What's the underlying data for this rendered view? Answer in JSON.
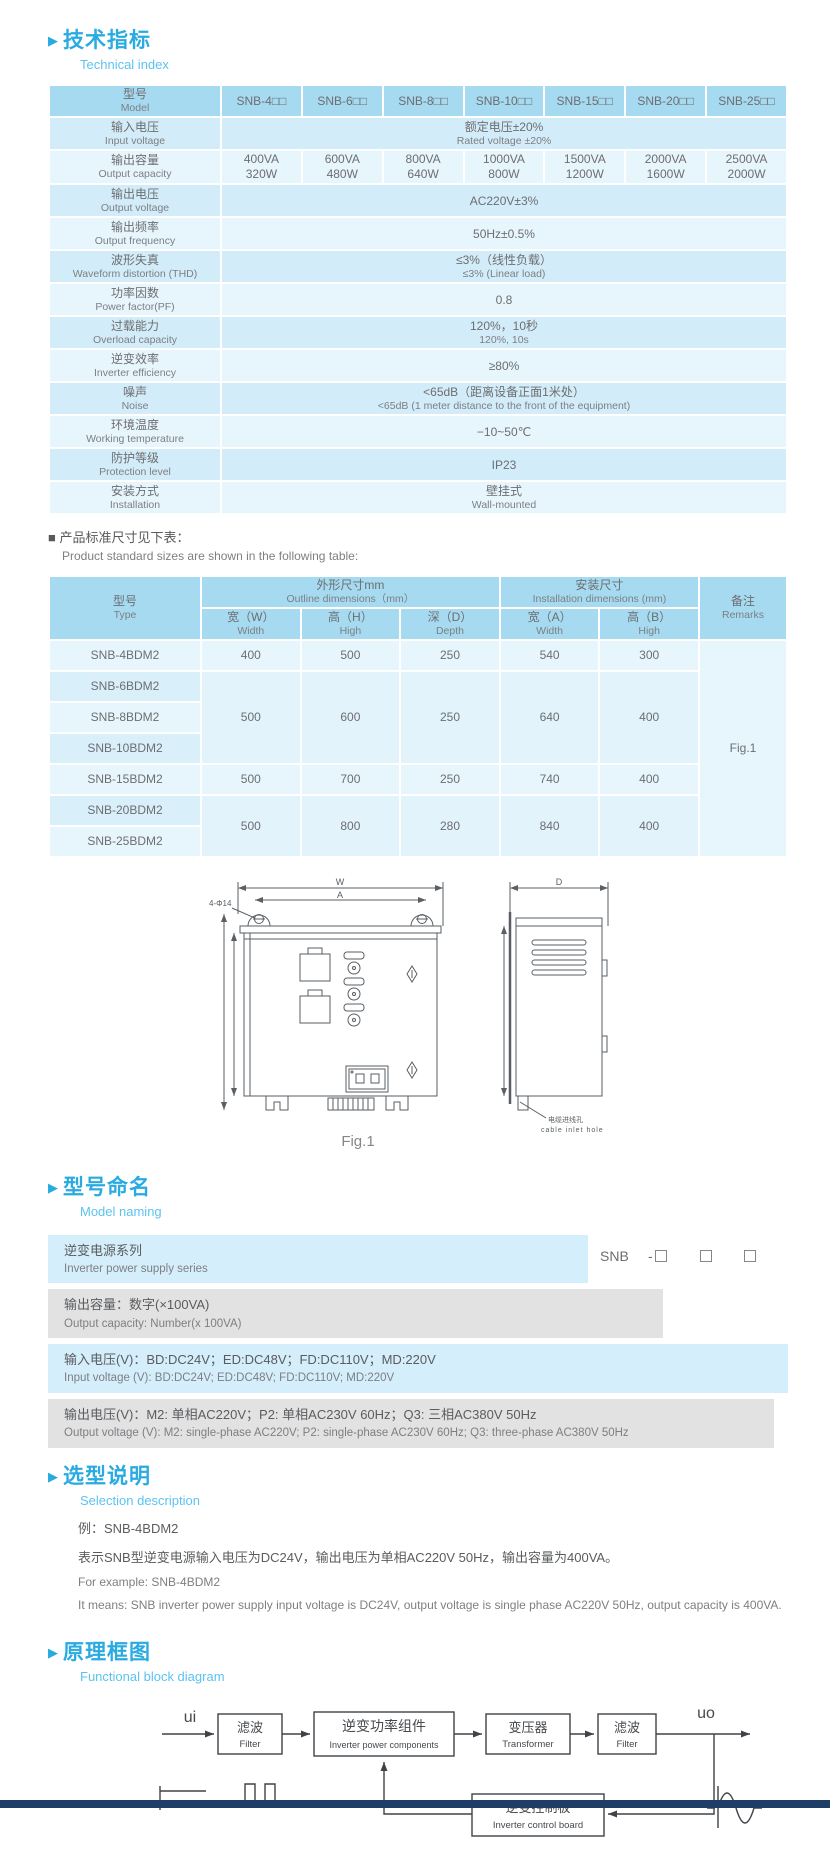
{
  "colors": {
    "accent": "#29abe2",
    "accent_light": "#5cc3f0",
    "table_header_bg": "#a6daf1",
    "row_dark": "#d3ecf9",
    "row_light": "#e7f5fd",
    "blue_band": "#d5eefb",
    "gray_band": "#e2e2e3",
    "footer_bar": "#1e3e68",
    "text_gray": "#6d6e71"
  },
  "sections": {
    "technical": {
      "zh": "技术指标",
      "en": "Technical index"
    },
    "naming": {
      "zh": "型号命名",
      "en": "Model naming"
    },
    "selection": {
      "zh": "选型说明",
      "en": "Selection description"
    },
    "block": {
      "zh": "原理框图",
      "en": "Functional block diagram"
    }
  },
  "spec_table": {
    "model_label": {
      "zh": "型号",
      "en": "Model"
    },
    "models": [
      "SNB-4□□",
      "SNB-6□□",
      "SNB-8□□",
      "SNB-10□□",
      "SNB-15□□",
      "SNB-20□□",
      "SNB-25□□"
    ],
    "rows": {
      "input_voltage": {
        "zh": "输入电压",
        "en": "Input voltage",
        "val_zh": "额定电压±20%",
        "val_en": "Rated voltage ±20%"
      },
      "output_capacity": {
        "zh": "输出容量",
        "en": "Output capacity",
        "va": [
          "400VA",
          "600VA",
          "800VA",
          "1000VA",
          "1500VA",
          "2000VA",
          "2500VA"
        ],
        "w": [
          "320W",
          "480W",
          "640W",
          "800W",
          "1200W",
          "1600W",
          "2000W"
        ]
      },
      "output_voltage": {
        "zh": "输出电压",
        "en": "Output voltage",
        "val": "AC220V±3%"
      },
      "output_frequency": {
        "zh": "输出频率",
        "en": "Output frequency",
        "val": "50Hz±0.5%"
      },
      "waveform": {
        "zh": "波形失真",
        "en": "Waveform distortion (THD)",
        "val_zh": "≤3%（线性负载）",
        "val_en": "≤3% (Linear load)"
      },
      "power_factor": {
        "zh": "功率因数",
        "en": "Power factor(PF)",
        "val": "0.8"
      },
      "overload": {
        "zh": "过载能力",
        "en": "Overload capacity",
        "val_zh": "120%，10秒",
        "val_en": "120%, 10s"
      },
      "efficiency": {
        "zh": "逆变效率",
        "en": "Inverter efficiency",
        "val": "≥80%"
      },
      "noise": {
        "zh": "噪声",
        "en": "Noise",
        "val_zh": "<65dB（距离设备正面1米处）",
        "val_en": "<65dB (1 meter distance to the front of the equipment)"
      },
      "temperature": {
        "zh": "环境温度",
        "en": "Working temperature",
        "val": "−10~50℃"
      },
      "protection": {
        "zh": "防护等级",
        "en": "Protection level",
        "val": "IP23"
      },
      "installation": {
        "zh": "安装方式",
        "en": "Installation",
        "val_zh": "壁挂式",
        "val_en": "Wall-mounted"
      }
    }
  },
  "size_note": {
    "bullet": "■",
    "zh": "产品标准尺寸见下表：",
    "en": "Product standard sizes are shown in the following table:"
  },
  "dim_table": {
    "type_label": {
      "zh": "型号",
      "en": "Type"
    },
    "outline_label": {
      "zh": "外形尺寸mm",
      "en": "Outline dimensions（mm）"
    },
    "install_label": {
      "zh": "安装尺寸",
      "en": "Installation dimensions (mm)"
    },
    "remarks_label": {
      "zh": "备注",
      "en": "Remarks"
    },
    "cols": [
      {
        "zh": "宽（W）",
        "en": "Width"
      },
      {
        "zh": "高（H）",
        "en": "High"
      },
      {
        "zh": "深（D）",
        "en": "Depth"
      },
      {
        "zh": "宽（A）",
        "en": "Width"
      },
      {
        "zh": "高（B）",
        "en": "High"
      }
    ],
    "rows": [
      {
        "type": "SNB-4BDM2",
        "w": "400",
        "h": "500",
        "d": "250",
        "a": "540",
        "b": "300"
      },
      {
        "type": "SNB-6BDM2"
      },
      {
        "type": "SNB-8BDM2",
        "w": "500",
        "h": "600",
        "d": "250",
        "a": "640",
        "b": "400"
      },
      {
        "type": "SNB-10BDM2"
      },
      {
        "type": "SNB-15BDM2",
        "w": "500",
        "h": "700",
        "d": "250",
        "a": "740",
        "b": "400"
      },
      {
        "type": "SNB-20BDM2",
        "w": "500",
        "h": "800",
        "d": "280",
        "a": "840",
        "b": "400"
      },
      {
        "type": "SNB-25BDM2"
      }
    ],
    "remark": "Fig.1"
  },
  "figure": {
    "dim_w": "W",
    "dim_a": "A",
    "dim_d": "D",
    "holes": "4-Φ14",
    "cable_zh": "电缆进线孔",
    "cable_en": "cable inlet hole",
    "caption": "Fig.1"
  },
  "naming": {
    "code": {
      "series": "SNB",
      "dash": "-"
    },
    "rows": [
      {
        "zh": "逆变电源系列",
        "en": "Inverter power supply series"
      },
      {
        "zh": "输出容量：数字(×100VA)",
        "en": "Output capacity: Number(x 100VA)"
      },
      {
        "zh": "输入电压(V)：BD:DC24V；ED:DC48V；FD:DC110V；MD:220V",
        "en": "Input voltage (V): BD:DC24V;  ED:DC48V;  FD:DC110V; MD:220V"
      },
      {
        "zh": "输出电压(V)：M2: 单相AC220V；P2: 单相AC230V 60Hz；Q3: 三相AC380V 50Hz",
        "en": "Output voltage (V): M2: single-phase AC220V;  P2: single-phase AC230V 60Hz;  Q3: three-phase AC380V 50Hz"
      }
    ]
  },
  "selection": {
    "example_zh": "例：SNB-4BDM2",
    "desc_zh": "表示SNB型逆变电源输入电压为DC24V，输出电压为单相AC220V 50Hz，输出容量为400VA。",
    "example_en": "For example: SNB-4BDM2",
    "desc_en": "It means: SNB inverter power supply input voltage is DC24V, output voltage is single phase AC220V 50Hz, output capacity is 400VA."
  },
  "diagram": {
    "input": "ui",
    "output": "uo",
    "filter1": {
      "zh": "滤波",
      "en": "Filter"
    },
    "inverter": {
      "zh": "逆变功率组件",
      "en": "Inverter power components"
    },
    "transformer": {
      "zh": "变压器",
      "en": "Transformer"
    },
    "filter2": {
      "zh": "滤波",
      "en": "Filter"
    },
    "control": {
      "zh": "逆变控制板",
      "en": "Inverter control board"
    }
  }
}
